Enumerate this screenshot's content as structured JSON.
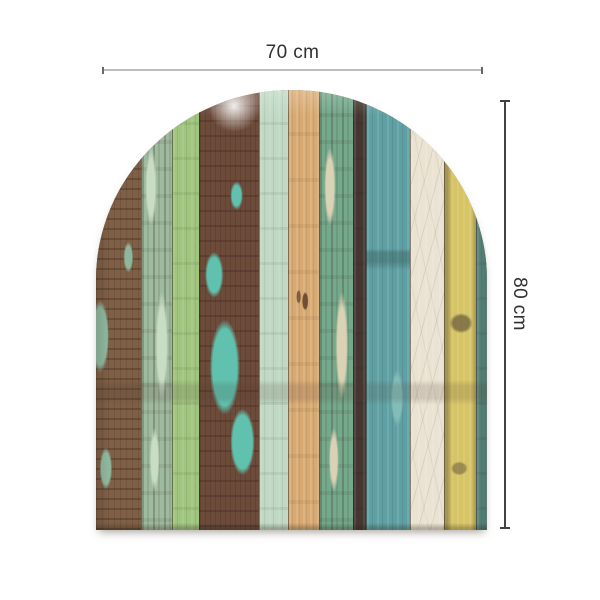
{
  "figure": {
    "type": "product-dimension-image",
    "background": "#ffffff",
    "subject": "arched panel of distressed painted wood planks"
  },
  "dimensions": {
    "width_label": "70 cm",
    "height_label": "80 cm",
    "width_line_color": "#bdbdbd",
    "height_line_color": "#424242",
    "label_color": "#303030"
  },
  "panel": {
    "name": "arched-wood-plank-panel",
    "shape": "arch-top-flat-bottom",
    "planks": [
      {
        "name": "plank-rustic-brown",
        "width_px": 45,
        "base": "#7f5f46",
        "accent": "#8fb79e",
        "texture": "rustic"
      },
      {
        "name": "plank-seafoam-mottled",
        "width_px": 31,
        "base": "#9fbb9f",
        "accent": "#c9dcc4",
        "texture": "mottle"
      },
      {
        "name": "plank-apple-green",
        "width_px": 27,
        "base": "#a0c57e",
        "accent": "#b9d69b",
        "texture": "flat"
      },
      {
        "name": "plank-brown-turquoise-peel",
        "width_px": 60,
        "base": "#6d4b3a",
        "accent": "#5fc1ae",
        "texture": "peel"
      },
      {
        "name": "plank-pale-seafoam",
        "width_px": 29,
        "base": "#c0d8c4",
        "accent": "#ddeadd",
        "texture": "flat"
      },
      {
        "name": "plank-tan-wood",
        "width_px": 31,
        "base": "#d8aa73",
        "accent": "#e9cb97",
        "texture": "wood"
      },
      {
        "name": "plank-green-mottled",
        "width_px": 34,
        "base": "#74a98b",
        "accent": "#d9d2b4",
        "texture": "mottle"
      },
      {
        "name": "plank-dark-brown",
        "width_px": 13,
        "base": "#463831",
        "accent": "#5d4c41",
        "texture": "flat"
      },
      {
        "name": "plank-teal-blue",
        "width_px": 44,
        "base": "#5fa0a4",
        "accent": "#82bdb9",
        "texture": "teal"
      },
      {
        "name": "plank-cream",
        "width_px": 34,
        "base": "#eae2d2",
        "accent": "#f7f1e5",
        "texture": "crinkle"
      },
      {
        "name": "plank-yellow",
        "width_px": 32,
        "base": "#d6c465",
        "accent": "#e7da89",
        "texture": "yellowed"
      },
      {
        "name": "plank-dark-teal-edge",
        "width_px": 11,
        "base": "#5b877d",
        "accent": "#78a599",
        "texture": "flat"
      }
    ]
  }
}
